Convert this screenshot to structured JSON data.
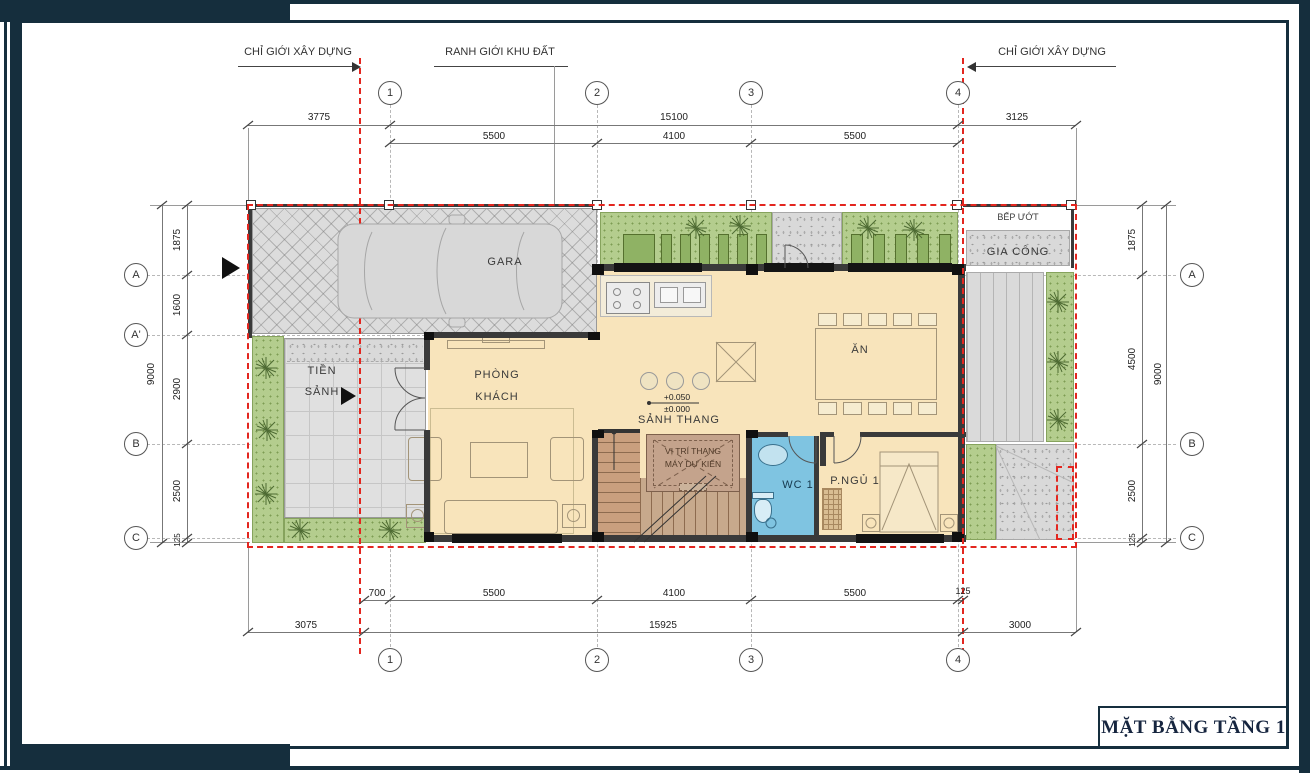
{
  "frame": {
    "title": "MẶT BẰNG TẦNG 1"
  },
  "annotations": {
    "building_line_left": "CHỈ GIỚI XÂY DỰNG",
    "land_boundary": "RANH GIỚI KHU ĐẤT",
    "building_line_right": "CHỈ GIỚI XÂY DỰNG"
  },
  "grid": {
    "columns": [
      "1",
      "2",
      "3",
      "4"
    ],
    "rows_left": [
      "A",
      "A'",
      "B",
      "C"
    ],
    "rows_right": [
      "A",
      "B",
      "C"
    ]
  },
  "dimensions": {
    "top_row1": [
      "3775",
      "15100",
      "3125"
    ],
    "top_row2": [
      "5500",
      "4100",
      "5500"
    ],
    "bottom_row1": [
      "700",
      "5500",
      "4100",
      "5500",
      "125"
    ],
    "bottom_row2": [
      "3075",
      "15925",
      "3000"
    ],
    "left_segments": [
      "1875",
      "1600",
      "2900",
      "2500",
      "125"
    ],
    "left_total": "9000",
    "right_segments": [
      "1875",
      "4500",
      "2500",
      "125"
    ],
    "right_total": "9000"
  },
  "rooms": {
    "gara": "GARA",
    "tien_sanh_line1": "TIỀN",
    "tien_sanh_line2": "SẢNH",
    "phong_khach_line1": "PHÒNG",
    "phong_khach_line2": "KHÁCH",
    "sanh_thang": "SẢNH THANG",
    "an": "ĂN",
    "wc1": "WC 1",
    "p_ngu1": "P.NGỦ 1",
    "bep_uot": "BẾP ƯỚT",
    "gia_cong": "GIA CÔNG",
    "elevator_line1": "VỊ TRÍ THANG",
    "elevator_line2": "MÁY DỰ KIẾN"
  },
  "levels": {
    "upper": "+0.050",
    "lower": "±0.000"
  },
  "colors": {
    "frame_navy": "#152e3d",
    "boundary_red": "#e3261f",
    "floor_beige": "#f8e4bb",
    "garden_green": "#b4cd8e",
    "wc_blue": "#7fc4e1",
    "stair_brown": "#c99f7e",
    "wall_dark": "#3a3a3a"
  }
}
